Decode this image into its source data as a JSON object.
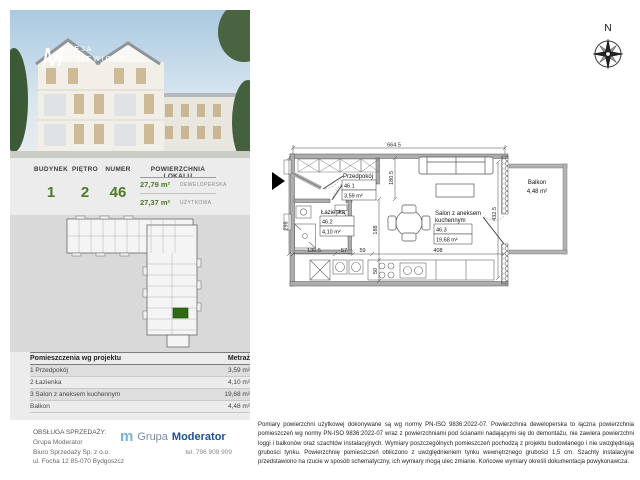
{
  "colors": {
    "accent_green": "#4a7a23",
    "unit_highlight": "#2f6a15",
    "brand_blue_dark": "#1d4f97",
    "brand_blue_light": "#79b2dd"
  },
  "hero": {
    "brand_monogram": "M",
    "brand_line1": "ALEJA",
    "brand_line2": "MICKIEWICZA"
  },
  "spec": {
    "col1_header": "BUDYNEK",
    "col1_value": "1",
    "col2_header": "PIĘTRO",
    "col2_value": "2",
    "col3_header": "NUMER",
    "col3_value": "46",
    "col4_header": "POWIERZCHNIA LOKALU",
    "area_developer": "27,79 m²",
    "area_developer_label": "DEWELOPERSKA",
    "area_usable": "27,37 m²",
    "area_usable_label": "UŻYTKOWA"
  },
  "rooms_table": {
    "header_name": "Pomieszczenia wg projektu",
    "header_area": "Metraż",
    "rows": [
      {
        "name": "1 Przedpokój",
        "area": "3,59 m²"
      },
      {
        "name": "2 Łazienka",
        "area": "4,10 m²"
      },
      {
        "name": "3 Salon z aneksem kuchennym",
        "area": "19,68 m²"
      },
      {
        "name": "Balkon",
        "area": "4,48 m²"
      }
    ]
  },
  "floor_plan": {
    "rooms": [
      {
        "name": "Przedpokój",
        "number": "46.1",
        "area": "3,59 m²"
      },
      {
        "name": "Łazienka",
        "number": "46.2",
        "area": "4,10 m²"
      },
      {
        "name_line1": "Salon z aneksem",
        "name_line2": "kuchennym",
        "number": "46.3",
        "area": "19,68 m²"
      },
      {
        "name": "Balkon",
        "area": "4,48 m²"
      }
    ],
    "dimensions": {
      "top": "664.5",
      "hall_height": "180.5",
      "left": "298",
      "mid": "188",
      "mid_small": "50",
      "right": "432.5",
      "bottom": [
        "130.5",
        "57",
        "59",
        "408"
      ]
    }
  },
  "compass": {
    "north_label": "N"
  },
  "footer": {
    "sales_label": "OBSŁUGA SPRZEDAŻY:",
    "company": "Grupa Moderator",
    "office": "Biuro Sprzedaży Sp. z o.o.",
    "address": "ul. Focha 12 85-070 Bydgoszcz",
    "phone": "tel. 796 909 909",
    "logo_m": "m",
    "logo_grupa": "Grupa",
    "logo_moderator": "Moderator"
  },
  "legal": "Pomiary powierzchni użytkowej dokonywane są wg normy PN-ISO 9836:2022-07. Powierzchnia deweloperska to łączna powierzchnia pomieszczeń wg normy PN-ISO 9836:2022-07 wraz z powierzchniami pod ścianami nadającymi się do demontażu, nie zawiera powierzchni loggi i balkonów oraz szachtów instalacyjnych. Wymiary poszczególnych pomieszczeń pochodzą z projektu budowlanego i nie uwzględniają grubości tynku. Powierzchnię pomieszczeń obliczono z uwzględnieniem tynku wewnętrznego grubości 1,5 cm. Szachty instalacyjne przedstawiono na rzucie w sposób schematyczny, ich wymiary mogą ulec zmianie. Końcowe wymiary określi dokumentacja powykonawcza."
}
